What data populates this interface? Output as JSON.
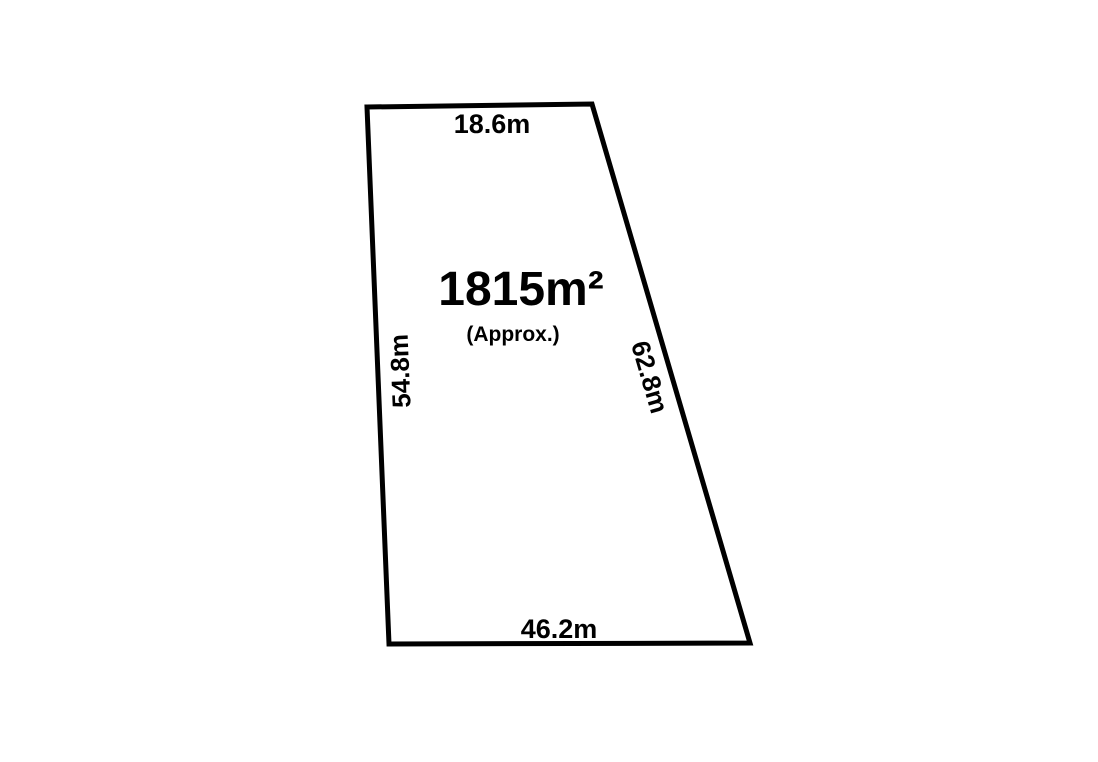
{
  "diagram": {
    "area_value": "1815m²",
    "area_note": "(Approx.)",
    "dimensions": {
      "top": "18.6m",
      "left": "54.8m",
      "right": "62.8m",
      "bottom": "46.2m"
    },
    "colors": {
      "outline": "#000000",
      "text": "#000000",
      "parcel_fill": "#ffffff",
      "background": "#ffffff"
    }
  }
}
